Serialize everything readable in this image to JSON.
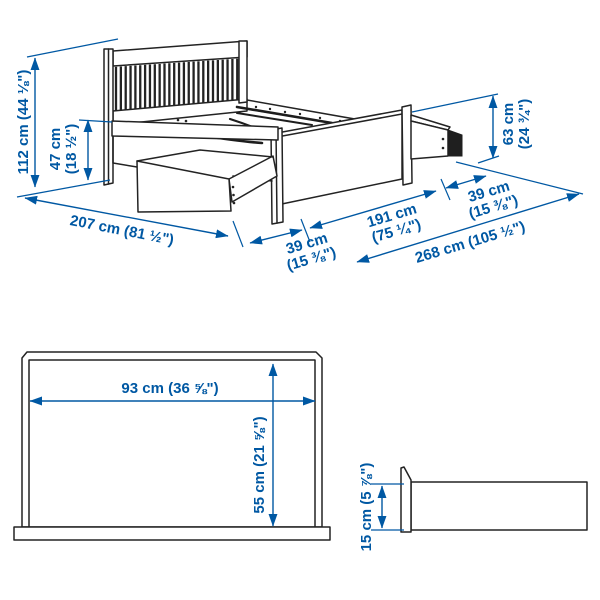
{
  "colors": {
    "dimension_blue": "#0058a3",
    "artwork_line": "#232323",
    "background": "#ffffff"
  },
  "bed_view": {
    "dimensions": {
      "headboard_height": {
        "full": "112 cm (44 ⅛\")",
        "cm": "112 cm",
        "inches": "(44 ⅛\")"
      },
      "side_rail_height": {
        "cm": "47 cm",
        "inches": "(18 ½\")"
      },
      "footboard_height": {
        "cm": "63 cm",
        "inches": "(24 ¾\")"
      },
      "bed_length": {
        "full": "207 cm (81 ½\")"
      },
      "drawer_extension_left": {
        "cm": "39 cm",
        "inches": "(15 ⅜\")"
      },
      "bed_width": {
        "cm": "191 cm",
        "inches": "(75 ¼\")"
      },
      "drawer_extension_right": {
        "cm": "39 cm",
        "inches": "(15 ⅜\")"
      },
      "total_clearance_width": {
        "full": "268 cm (105 ½\")"
      }
    }
  },
  "drawer_top_view": {
    "dimensions": {
      "inner_width": {
        "full": "93 cm (36 ⅝\")"
      },
      "inner_depth": {
        "full": "55 cm (21 ⅝\")"
      }
    }
  },
  "drawer_side_view": {
    "dimensions": {
      "inner_height": {
        "full": "15 cm (5 ⅞\")"
      }
    }
  }
}
